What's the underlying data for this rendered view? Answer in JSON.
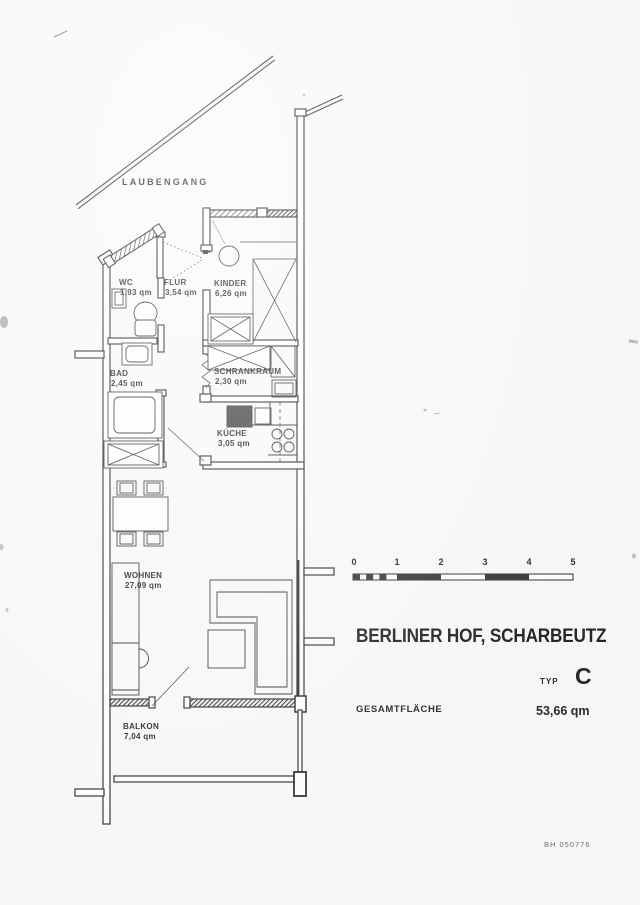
{
  "document": {
    "corridor_label": "LAUBENGANG",
    "drawing_number": "BH 050776"
  },
  "rooms": [
    {
      "name": "WC",
      "area": "1,93 qm"
    },
    {
      "name": "FLUR",
      "area": "3,54 qm"
    },
    {
      "name": "KINDER",
      "area": "6,26 qm"
    },
    {
      "name": "BAD",
      "area": "2,45 qm"
    },
    {
      "name": "SCHRANKRAUM",
      "area": "2,30 qm"
    },
    {
      "name": "KÜCHE",
      "area": "3,05 qm"
    },
    {
      "name": "WOHNEN",
      "area": "27,09 qm"
    },
    {
      "name": "BALKON",
      "area": "7,04 qm"
    }
  ],
  "scale_bar": {
    "ticks": [
      "0",
      "1",
      "2",
      "3",
      "4",
      "5"
    ]
  },
  "title_block": {
    "project": "BERLINER HOF, SCHARBEUTZ",
    "type_label": "TYP",
    "type_value": "C",
    "total_label": "GESAMTFLÄCHE",
    "total_value": "53,66 qm"
  },
  "colors": {
    "ink": "#2f2f2f",
    "paper": "#fbfaf8"
  }
}
